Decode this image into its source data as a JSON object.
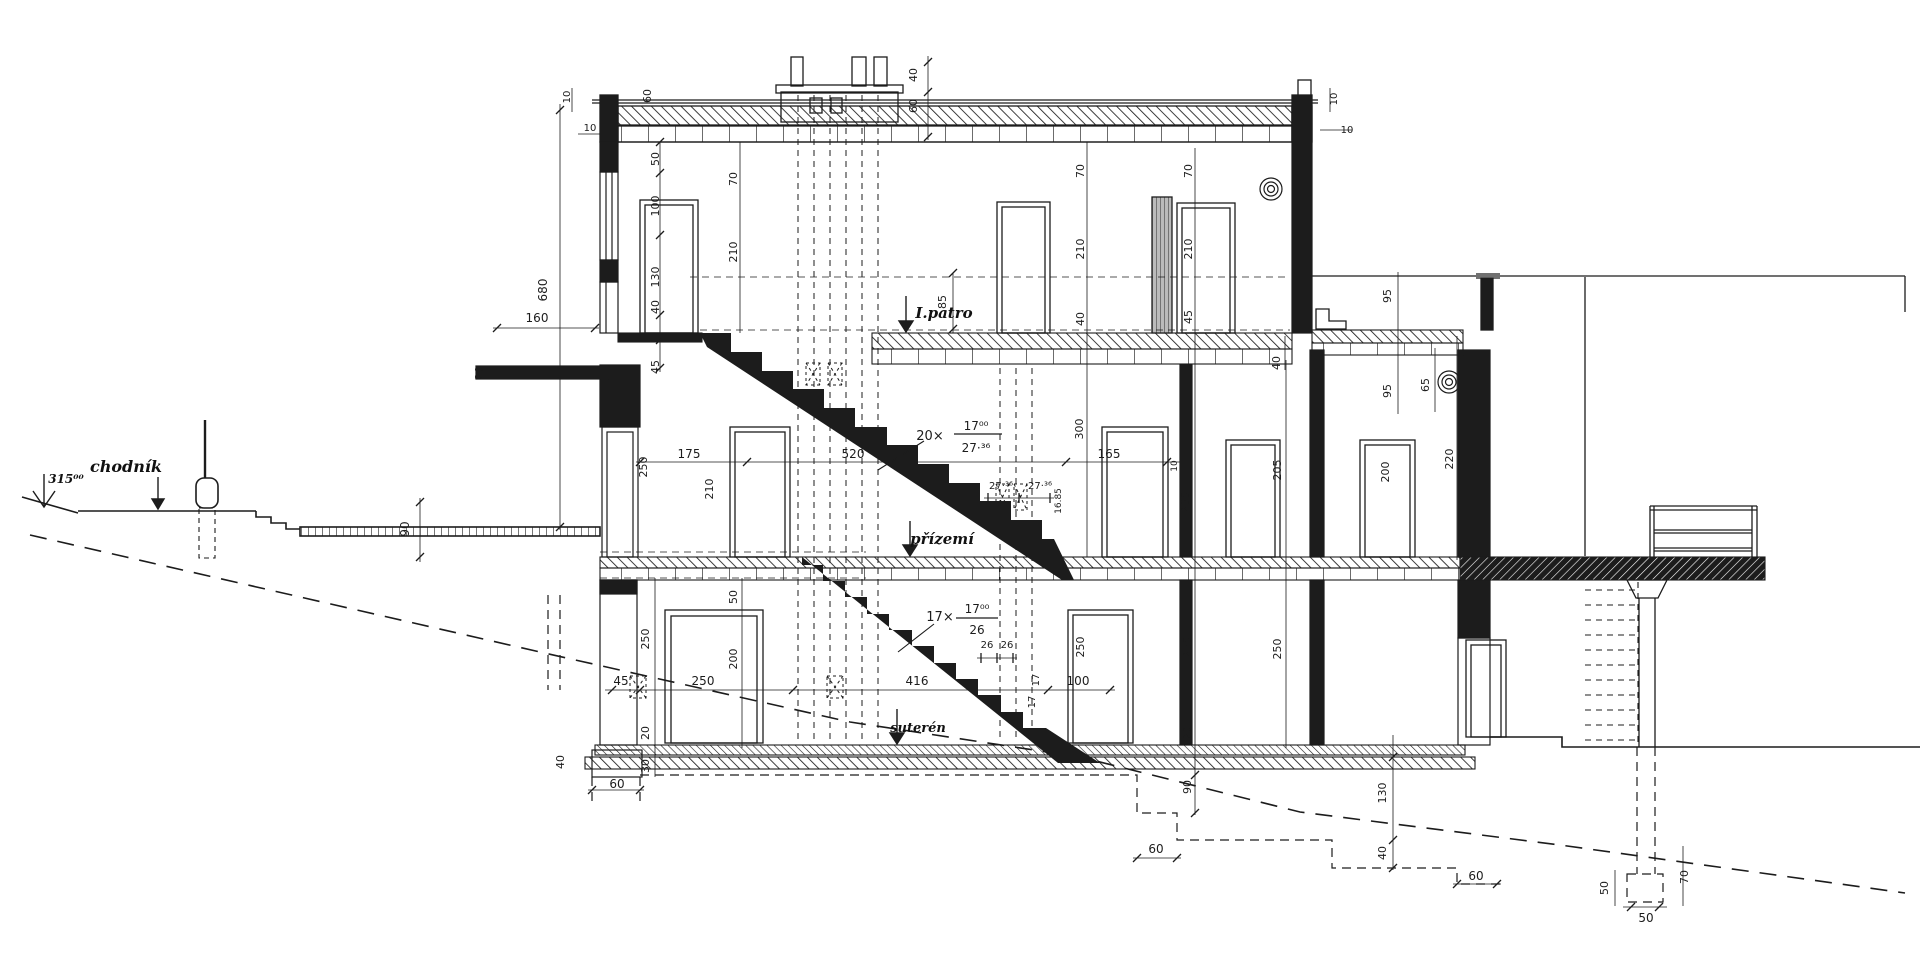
{
  "drawing": {
    "kind": "building cross-section (hand drawn)",
    "floor_labels": [
      "I.patro",
      "přízemí",
      "suterén"
    ],
    "site_labels": [
      "chodník",
      "315⁰⁰"
    ],
    "stair_upper": {
      "count": "20×",
      "riser": "17⁰⁰",
      "tread": "27·³⁶"
    },
    "stair_lower": {
      "count": "17×",
      "riser": "17⁰⁰",
      "tread": "26"
    },
    "texts": [
      {
        "t": "chodník",
        "x": 126,
        "y": 472,
        "s": 16,
        "k": "label",
        "n": "sidewalk-label"
      },
      {
        "t": "315⁰⁰",
        "x": 66,
        "y": 483,
        "s": 12,
        "k": "label",
        "n": "elevation-label"
      },
      {
        "t": "I.patro",
        "x": 944,
        "y": 318,
        "s": 15,
        "k": "label",
        "n": "first-floor-label"
      },
      {
        "t": "přízemí",
        "x": 942,
        "y": 544,
        "s": 15,
        "k": "label",
        "n": "ground-floor-label"
      },
      {
        "t": "suterén",
        "x": 918,
        "y": 732,
        "s": 13,
        "k": "label",
        "n": "basement-label"
      },
      {
        "t": "20×",
        "x": 930,
        "y": 440,
        "s": 13,
        "k": "stair"
      },
      {
        "t": "17⁰⁰",
        "x": 976,
        "y": 430,
        "s": 12,
        "k": "stair"
      },
      {
        "t": "27·³⁶",
        "x": 976,
        "y": 452,
        "s": 12,
        "k": "stair"
      },
      {
        "t": "17×",
        "x": 940,
        "y": 621,
        "s": 13,
        "k": "stair"
      },
      {
        "t": "17⁰⁰",
        "x": 977,
        "y": 613,
        "s": 12,
        "k": "stair"
      },
      {
        "t": "26",
        "x": 977,
        "y": 634,
        "s": 12,
        "k": "stair"
      },
      {
        "t": "27·³⁶",
        "x": 1001,
        "y": 489,
        "s": 10,
        "k": "dim"
      },
      {
        "t": "27·³⁶",
        "x": 1040,
        "y": 489,
        "s": 10,
        "k": "dim"
      },
      {
        "t": "26",
        "x": 987,
        "y": 648,
        "s": 10,
        "k": "dim"
      },
      {
        "t": "26",
        "x": 1007,
        "y": 648,
        "s": 10,
        "k": "dim"
      },
      {
        "t": "16.85",
        "x": 1061,
        "y": 501,
        "r": -90,
        "s": 9,
        "k": "dim"
      },
      {
        "t": "17",
        "x": 1039,
        "y": 680,
        "r": -90,
        "s": 10,
        "k": "dim"
      },
      {
        "t": "17",
        "x": 1035,
        "y": 702,
        "r": -90,
        "s": 10,
        "k": "dim"
      },
      {
        "t": "160",
        "x": 537,
        "y": 322,
        "s": 12,
        "k": "dim"
      },
      {
        "t": "10",
        "x": 590,
        "y": 131,
        "s": 10,
        "k": "dim"
      },
      {
        "t": "10",
        "x": 1347,
        "y": 133,
        "s": 10,
        "k": "dim"
      },
      {
        "t": "45",
        "x": 621,
        "y": 685,
        "s": 12,
        "k": "dim"
      },
      {
        "t": "250",
        "x": 703,
        "y": 685,
        "s": 12,
        "k": "dim"
      },
      {
        "t": "416",
        "x": 917,
        "y": 685,
        "s": 12,
        "k": "dim"
      },
      {
        "t": "100",
        "x": 1078,
        "y": 685,
        "s": 12,
        "k": "dim"
      },
      {
        "t": "175",
        "x": 689,
        "y": 458,
        "s": 12,
        "k": "dim"
      },
      {
        "t": "520",
        "x": 853,
        "y": 458,
        "s": 12,
        "k": "dim"
      },
      {
        "t": "165",
        "x": 1109,
        "y": 458,
        "s": 12,
        "k": "dim"
      },
      {
        "t": "60",
        "x": 617,
        "y": 788,
        "s": 12,
        "k": "dim"
      },
      {
        "t": "60",
        "x": 1156,
        "y": 853,
        "s": 12,
        "k": "dim"
      },
      {
        "t": "60",
        "x": 1476,
        "y": 880,
        "s": 12,
        "k": "dim"
      },
      {
        "t": "50",
        "x": 1646,
        "y": 922,
        "s": 12,
        "k": "dim"
      },
      {
        "t": "10",
        "x": 570,
        "y": 97,
        "r": -90,
        "s": 10,
        "k": "dim"
      },
      {
        "t": "60",
        "x": 651,
        "y": 96,
        "r": -90,
        "s": 11,
        "k": "dim"
      },
      {
        "t": "680",
        "x": 547,
        "y": 290,
        "r": -90,
        "s": 12,
        "k": "dim"
      },
      {
        "t": "20",
        "x": 483,
        "y": 373,
        "r": -90,
        "s": 11,
        "k": "dim"
      },
      {
        "t": "90",
        "x": 409,
        "y": 529,
        "r": -90,
        "s": 12,
        "k": "dim"
      },
      {
        "t": "40",
        "x": 917,
        "y": 75,
        "r": -90,
        "s": 11,
        "k": "dim"
      },
      {
        "t": "60",
        "x": 917,
        "y": 106,
        "r": -90,
        "s": 11,
        "k": "dim"
      },
      {
        "t": "50",
        "x": 659,
        "y": 159,
        "r": -90,
        "s": 11,
        "k": "dim"
      },
      {
        "t": "100",
        "x": 659,
        "y": 206,
        "r": -90,
        "s": 11,
        "k": "dim"
      },
      {
        "t": "130",
        "x": 659,
        "y": 277,
        "r": -90,
        "s": 11,
        "k": "dim"
      },
      {
        "t": "40",
        "x": 659,
        "y": 307,
        "r": -90,
        "s": 11,
        "k": "dim"
      },
      {
        "t": "45",
        "x": 659,
        "y": 367,
        "r": -90,
        "s": 11,
        "k": "dim"
      },
      {
        "t": "70",
        "x": 737,
        "y": 179,
        "r": -90,
        "s": 11,
        "k": "dim"
      },
      {
        "t": "210",
        "x": 737,
        "y": 252,
        "r": -90,
        "s": 11,
        "k": "dim"
      },
      {
        "t": "70",
        "x": 1084,
        "y": 171,
        "r": -90,
        "s": 11,
        "k": "dim"
      },
      {
        "t": "210",
        "x": 1084,
        "y": 249,
        "r": -90,
        "s": 11,
        "k": "dim"
      },
      {
        "t": "40",
        "x": 1084,
        "y": 319,
        "r": -90,
        "s": 11,
        "k": "dim"
      },
      {
        "t": "70",
        "x": 1192,
        "y": 171,
        "r": -90,
        "s": 11,
        "k": "dim"
      },
      {
        "t": "210",
        "x": 1192,
        "y": 249,
        "r": -90,
        "s": 11,
        "k": "dim"
      },
      {
        "t": "45",
        "x": 1192,
        "y": 317,
        "r": -90,
        "s": 11,
        "k": "dim"
      },
      {
        "t": "10",
        "x": 1337,
        "y": 99,
        "r": -90,
        "s": 10,
        "k": "dim"
      },
      {
        "t": "85",
        "x": 946,
        "y": 302,
        "r": -90,
        "s": 11,
        "k": "dim"
      },
      {
        "t": "95",
        "x": 1391,
        "y": 296,
        "r": -90,
        "s": 11,
        "k": "dim"
      },
      {
        "t": "95",
        "x": 1391,
        "y": 391,
        "r": -90,
        "s": 11,
        "k": "dim"
      },
      {
        "t": "65",
        "x": 1429,
        "y": 385,
        "r": -90,
        "s": 11,
        "k": "dim"
      },
      {
        "t": "40",
        "x": 1280,
        "y": 363,
        "r": -90,
        "s": 11,
        "k": "dim"
      },
      {
        "t": "300",
        "x": 1083,
        "y": 429,
        "r": -90,
        "s": 11,
        "k": "dim"
      },
      {
        "t": "250",
        "x": 647,
        "y": 467,
        "r": -90,
        "s": 11,
        "k": "dim"
      },
      {
        "t": "210",
        "x": 713,
        "y": 489,
        "r": -90,
        "s": 11,
        "k": "dim"
      },
      {
        "t": "10",
        "x": 1177,
        "y": 466,
        "r": -90,
        "s": 9,
        "k": "dim"
      },
      {
        "t": "230",
        "x": 1189,
        "y": 502,
        "r": -90,
        "s": 11,
        "k": "dim"
      },
      {
        "t": "205",
        "x": 1281,
        "y": 470,
        "r": -90,
        "s": 11,
        "k": "dim"
      },
      {
        "t": "200",
        "x": 1389,
        "y": 472,
        "r": -90,
        "s": 11,
        "k": "dim"
      },
      {
        "t": "220",
        "x": 1453,
        "y": 459,
        "r": -90,
        "s": 11,
        "k": "dim"
      },
      {
        "t": "50",
        "x": 737,
        "y": 597,
        "r": -90,
        "s": 11,
        "k": "dim"
      },
      {
        "t": "200",
        "x": 737,
        "y": 659,
        "r": -90,
        "s": 11,
        "k": "dim"
      },
      {
        "t": "250",
        "x": 649,
        "y": 639,
        "r": -90,
        "s": 11,
        "k": "dim"
      },
      {
        "t": "20",
        "x": 649,
        "y": 733,
        "r": -90,
        "s": 11,
        "k": "dim"
      },
      {
        "t": "30",
        "x": 649,
        "y": 766,
        "r": -90,
        "s": 11,
        "k": "dim"
      },
      {
        "t": "250",
        "x": 1084,
        "y": 647,
        "r": -90,
        "s": 11,
        "k": "dim"
      },
      {
        "t": "250",
        "x": 1191,
        "y": 647,
        "r": -90,
        "s": 11,
        "k": "dim"
      },
      {
        "t": "20",
        "x": 1191,
        "y": 733,
        "r": -90,
        "s": 11,
        "k": "dim"
      },
      {
        "t": "90",
        "x": 1191,
        "y": 787,
        "r": -90,
        "s": 11,
        "k": "dim"
      },
      {
        "t": "250",
        "x": 1281,
        "y": 649,
        "r": -90,
        "s": 11,
        "k": "dim"
      },
      {
        "t": "40",
        "x": 564,
        "y": 762,
        "r": -90,
        "s": 11,
        "k": "dim"
      },
      {
        "t": "130",
        "x": 1386,
        "y": 793,
        "r": -90,
        "s": 11,
        "k": "dim"
      },
      {
        "t": "40",
        "x": 1386,
        "y": 853,
        "r": -90,
        "s": 11,
        "k": "dim"
      },
      {
        "t": "50",
        "x": 1608,
        "y": 888,
        "r": -90,
        "s": 11,
        "k": "dim"
      },
      {
        "t": "70",
        "x": 1688,
        "y": 877,
        "r": -90,
        "s": 11,
        "k": "dim"
      }
    ]
  }
}
